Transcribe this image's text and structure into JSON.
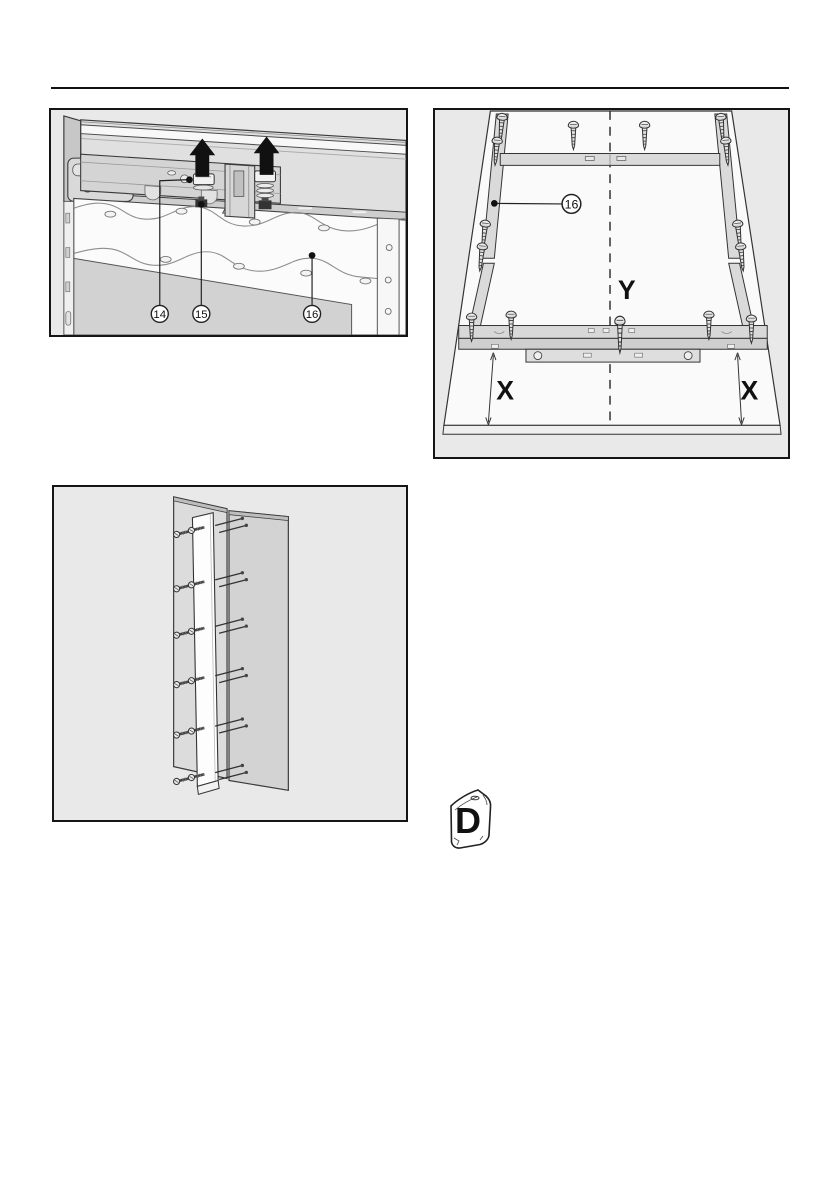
{
  "colors": {
    "page_bg": "#ffffff",
    "header_rule": "#111111",
    "frame_border": "#151515",
    "figure_bg": "#e9e9e9",
    "panel_white": "#fafafa",
    "rail_gray": "#d8d8d8",
    "arrow_black": "#111111"
  },
  "fig1": {
    "callouts": [
      {
        "label": "14"
      },
      {
        "label": "15"
      },
      {
        "label": "16"
      }
    ]
  },
  "fig2": {
    "callout": {
      "label": "16"
    },
    "labels": {
      "center": "Y",
      "left": "X",
      "right": "X"
    }
  },
  "bag": {
    "label": "D"
  }
}
